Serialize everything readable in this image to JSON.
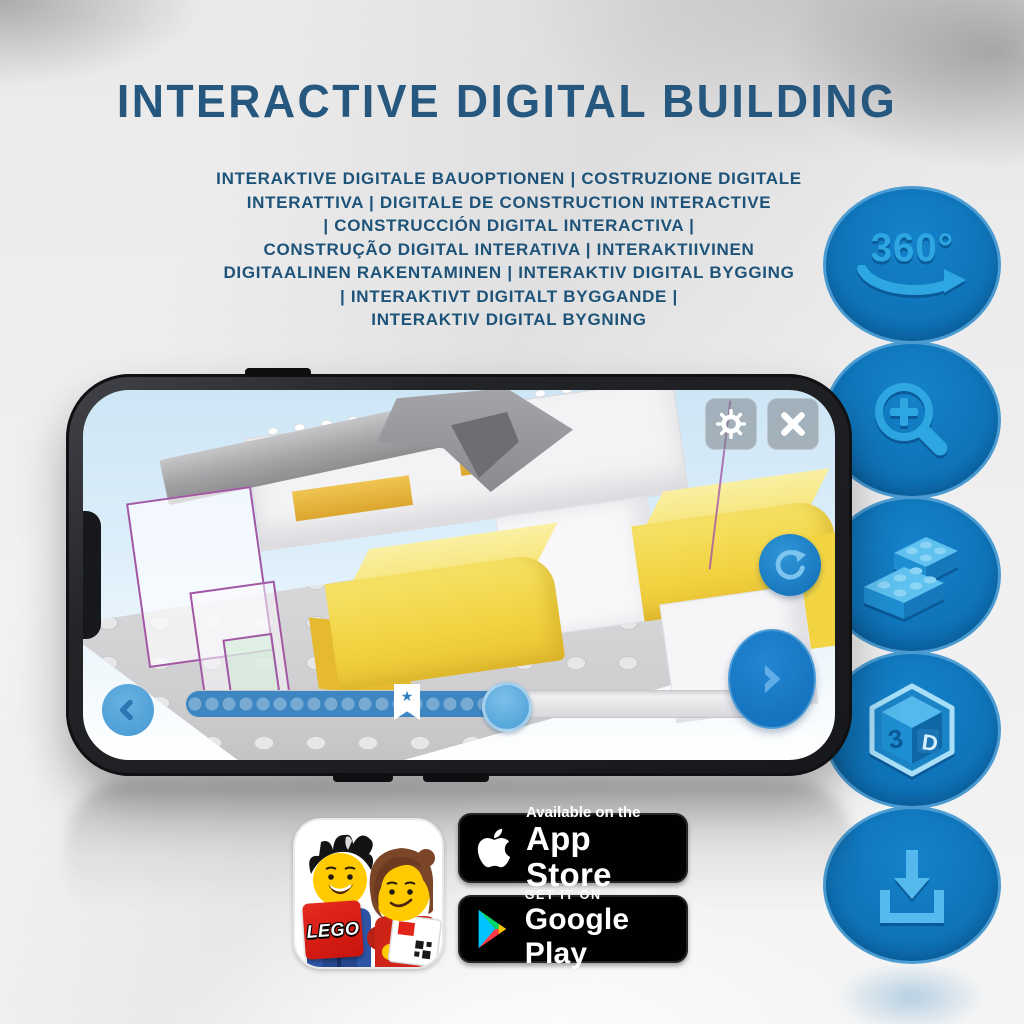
{
  "header": {
    "title": "INTERACTIVE DIGITAL BUILDING"
  },
  "subtitle": {
    "lines": [
      "INTERAKTIVE DIGITALE BAUOPTIONEN | COSTRUZIONE DIGITALE",
      "INTERATTIVA | DIGITALE DE CONSTRUCTION INTERACTIVE",
      "| CONSTRUCCIÓN DIGITAL INTERACTIVA |",
      "CONSTRUÇÃO DIGITAL INTERATIVA | INTERAKTIIVINEN",
      "DIGITAALINEN RAKENTAMINEN | INTERAKTIV DIGITAL BYGGING",
      "| INTERAKTIVT DIGITALT BYGGANDE |",
      "INTERAKTIV DIGITAL BYGNING"
    ]
  },
  "feature_icons": {
    "names": [
      "360-rotation-icon",
      "zoom-in-icon",
      "brick-building-icon",
      "3d-view-icon",
      "download-icon"
    ],
    "rotation_label": "360°",
    "cube_letter_left": "3",
    "cube_letter_right": "D"
  },
  "phone_app": {
    "slider_progress_percent": 55,
    "bookmark_star": "★",
    "icon_names": [
      "gear-icon",
      "close-icon",
      "refresh-icon",
      "back-chevron-icon",
      "next-chevron-icon"
    ]
  },
  "store_section": {
    "lego_logo_text": "LEGO",
    "app_store_badge": {
      "tagline": "Available on the",
      "store_name": "App Store"
    },
    "google_play_badge": {
      "tagline": "GET IT ON",
      "store_name": "Google Play"
    }
  },
  "colors": {
    "title_blue": "#26587f",
    "feature_circle_blue": "#0e72b7",
    "icon_light_blue": "#2da6e2",
    "slider_fill_blue": "#3e86c1",
    "yellow_brick": "#f2d443",
    "badge_black": "#010101"
  }
}
